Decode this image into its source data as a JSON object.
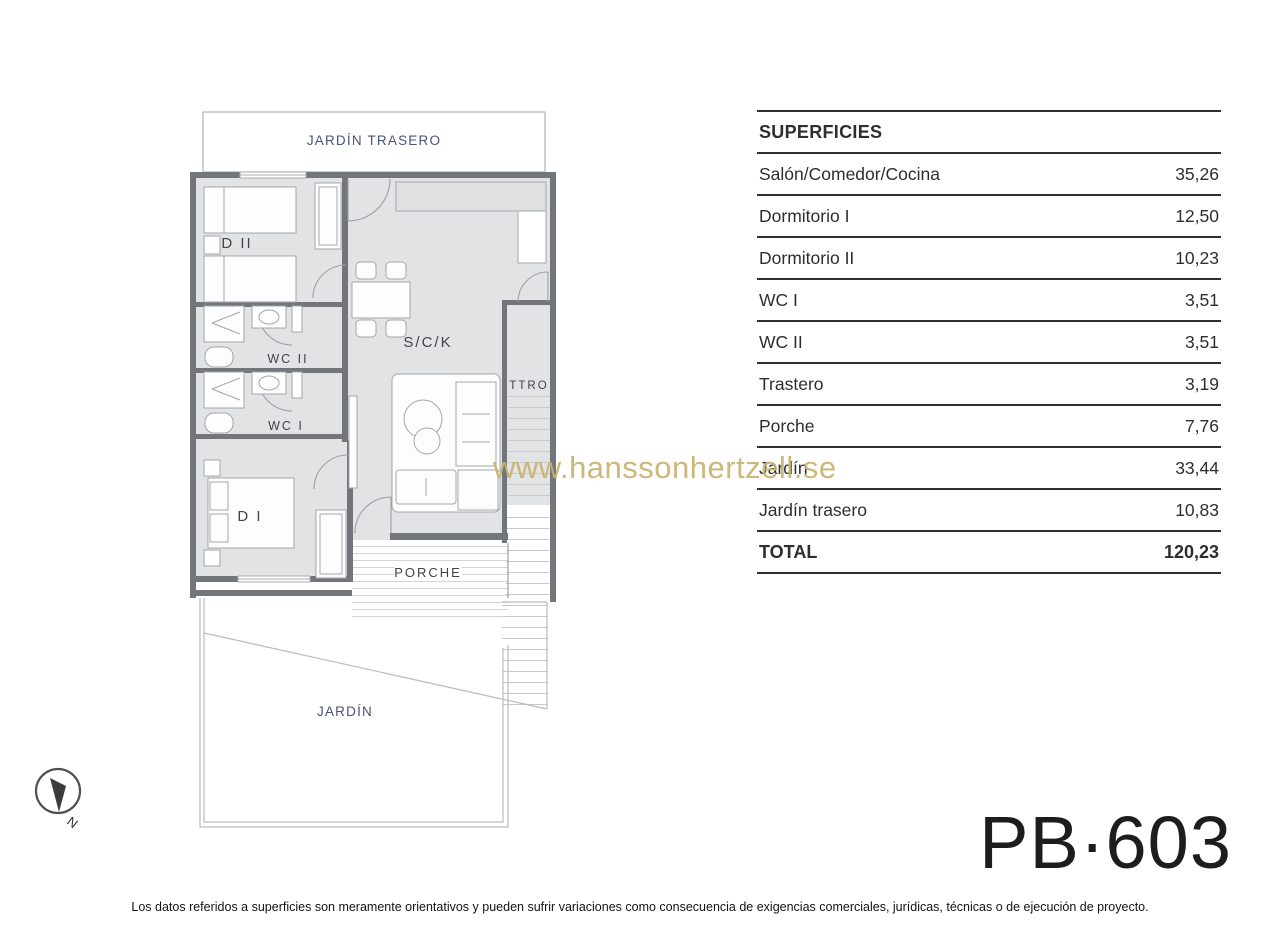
{
  "floor_plan": {
    "labels": {
      "jardin_trasero": "JARDÍN TRASERO",
      "dormitorio_2": "D II",
      "wc_2": "WC II",
      "wc_1": "WC I",
      "dormitorio_1": "D I",
      "salon_comedor_cocina": "S/C/K",
      "trastero": "TTRO",
      "porche": "PORCHE",
      "jardin": "JARDÍN"
    },
    "compass_label": "N"
  },
  "surfaces_table": {
    "title": "SUPERFICIES",
    "rows": [
      {
        "label": "Salón/Comedor/Cocina",
        "value": "35,26"
      },
      {
        "label": "Dormitorio I",
        "value": "12,50"
      },
      {
        "label": "Dormitorio II",
        "value": "10,23"
      },
      {
        "label": "WC I",
        "value": "3,51"
      },
      {
        "label": "WC II",
        "value": "3,51"
      },
      {
        "label": "Trastero",
        "value": "3,19"
      },
      {
        "label": "Porche",
        "value": "7,76"
      },
      {
        "label": "Jardín",
        "value": "33,44"
      },
      {
        "label": "Jardín trasero",
        "value": "10,83"
      }
    ],
    "total": {
      "label": "TOTAL",
      "value": "120,23"
    }
  },
  "watermark": "www.hanssonhertzell.se",
  "plan_code": "PB·603",
  "disclaimer": "Los datos referidos a superficies son meramente orientativos y pueden sufrir variaciones como consecuencia de exigencias comerciales, jurídicas, técnicas o de ejecución de proyecto.",
  "colors": {
    "label_navy": "#4a5278",
    "room_label": "#3f444b",
    "watermark_gold": "#c8b26e",
    "table_line": "#2f2f2f",
    "floor_fill": "#e2e3e4"
  }
}
